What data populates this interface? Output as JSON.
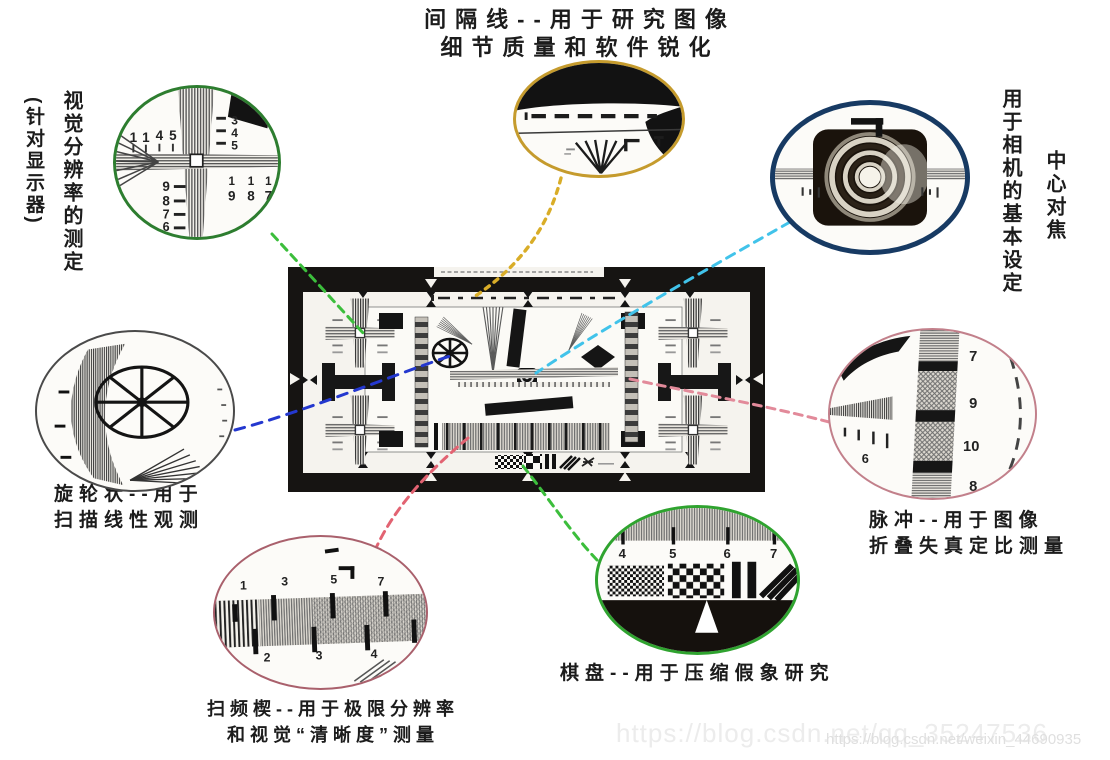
{
  "labels": {
    "interval": {
      "line1": "间隔线--用于研究图像",
      "line2": "细节质量和软件锐化"
    },
    "visual": {
      "main": "视觉分辨率的测定",
      "paren": "(针对显示器)"
    },
    "camera": {
      "main": "用于相机的基本设定",
      "sub": "中心对焦"
    },
    "wheel": {
      "line1": "旋轮状--用于",
      "line2": "扫描线性观测"
    },
    "pulse": {
      "line1": "脉冲--用于图像",
      "line2": "折叠失真定比测量"
    },
    "checkerboard": {
      "line1": "棋盘--用于压缩假象研究"
    },
    "sweep": {
      "line1": "扫频楔--用于极限分辨率",
      "line2": "和视觉“清晰度”测量"
    }
  },
  "magnifiers": {
    "cross": {
      "top_left": [
        "1",
        "1",
        "4",
        "5"
      ],
      "top_right": [
        "3",
        "4",
        "5"
      ],
      "bottom_left": [
        "9",
        "8",
        "7",
        "6"
      ],
      "fraction_numerator": "1",
      "bottom_right": [
        "9",
        "8",
        "7"
      ]
    },
    "pulse": {
      "right_numbers": [
        "7",
        "9",
        "10",
        "8"
      ],
      "left_number": "6"
    },
    "checkerboard": {
      "tick_numbers": [
        "4",
        "5",
        "6",
        "7"
      ]
    },
    "sweep": {
      "top_numbers": [
        "1",
        "3",
        "5",
        "7"
      ],
      "bottom_numbers": [
        "2",
        "3",
        "4"
      ]
    }
  },
  "watermark": {
    "large": "https://blog.csdn.net/qq_35247536",
    "small": "https://blog.csdn.net/weixin_44690935"
  },
  "colors": {
    "connector_top_left": "#3cbe3c",
    "connector_top": "#d9ad28",
    "connector_top_right": "#41c3ea",
    "connector_wheel": "#2438cf",
    "connector_pulse": "#e28a9a",
    "connector_sweep": "#e26372",
    "connector_checkerboard": "#3cbe3c",
    "ellipse_cross": "#2d7d2f",
    "ellipse_interval": "#c59b2d",
    "ellipse_focus": "#173a63",
    "ellipse_wheel": "#4a4a4a",
    "ellipse_pulse": "#c2808b",
    "ellipse_checkerboard": "#2fa32f",
    "ellipse_sweep": "#a9606c"
  }
}
